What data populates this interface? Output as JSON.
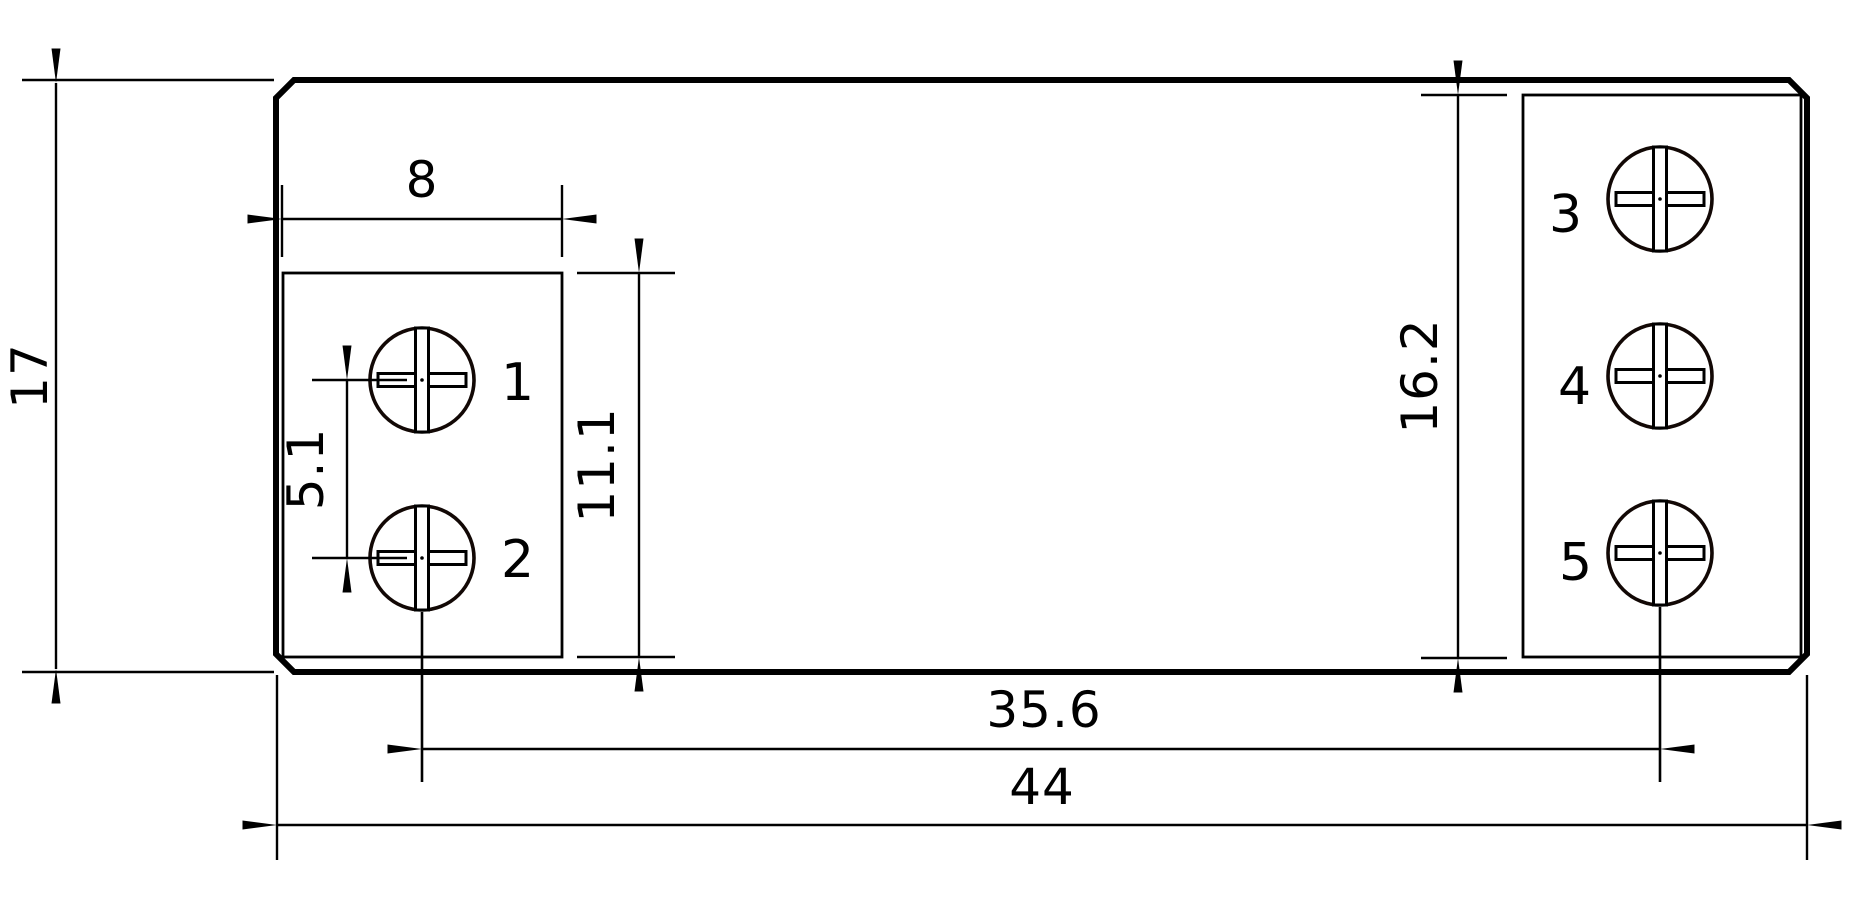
{
  "drawing": {
    "type": "technical-dimension-drawing",
    "description": "Relay footprint / terminal block outline drawing with screw terminals and dimensions",
    "dimensions": {
      "overall_height": "17",
      "overall_width": "44",
      "left_block_width": "8",
      "left_screw_pitch": "5.1",
      "left_block_height": "11.1",
      "right_block_height": "16.2",
      "screw_center_span": "35.6"
    },
    "terminal_labels": [
      "1",
      "2",
      "3",
      "4",
      "5"
    ],
    "colors": {
      "line": "#000000",
      "terminal_label_red": "#e92227",
      "background": "#ffffff"
    }
  }
}
